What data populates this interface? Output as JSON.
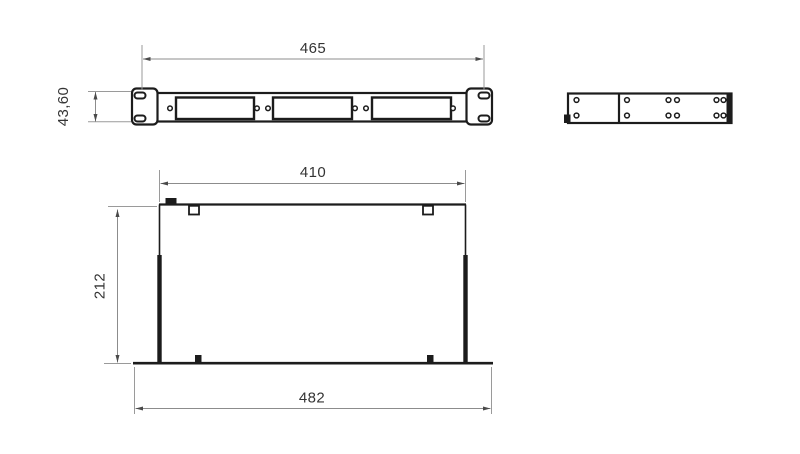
{
  "page": {
    "title": "1U rack panel technical drawing",
    "background": "#ffffff"
  },
  "colors": {
    "outline": "#1c1c1c",
    "dimension_line": "#8c8c8c",
    "dimension_text": "#343434"
  },
  "views": {
    "front": {
      "name": "front-view",
      "dim_width": "465",
      "dim_height": "43,60",
      "features": {
        "mounting_ears": 2,
        "ear_slots_per_ear": 2,
        "rectangular_cutouts": 3,
        "screw_holes": 6
      }
    },
    "side": {
      "name": "side-view",
      "features": {
        "sections": 2,
        "hole_rows": 2
      }
    },
    "top": {
      "name": "top-view",
      "dim_inner_width": "410",
      "dim_depth": "212",
      "dim_overall_width": "482",
      "features": {
        "top_tabs": 2,
        "bottom_tabs": 2
      }
    }
  }
}
